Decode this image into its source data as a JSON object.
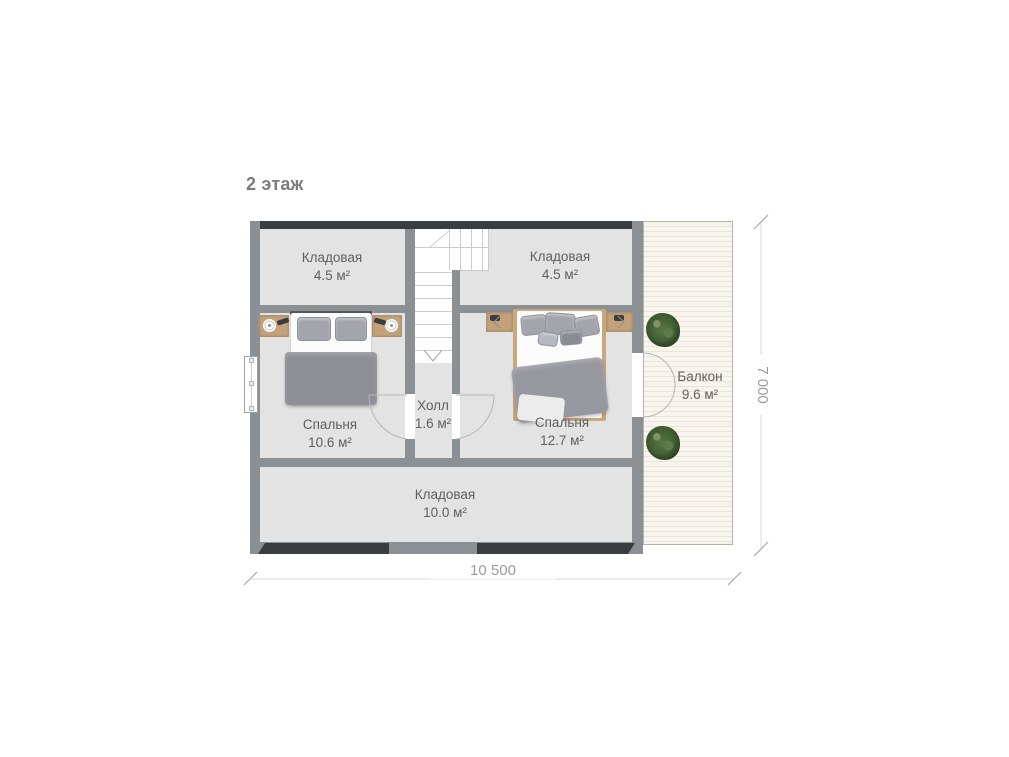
{
  "title": "2 этаж",
  "rooms": {
    "storage_top_left": {
      "name": "Кладовая",
      "area": "4.5 м²"
    },
    "storage_top_right": {
      "name": "Кладовая",
      "area": "4.5 м²"
    },
    "bedroom_left": {
      "name": "Спальня",
      "area": "10.6 м²"
    },
    "bedroom_right": {
      "name": "Спальня",
      "area": "12.7 м²"
    },
    "hall": {
      "name": "Холл",
      "area": "1.6 м²"
    },
    "storage_bottom": {
      "name": "Кладовая",
      "area": "10.0 м²"
    },
    "balcony": {
      "name": "Балкон",
      "area": "9.6 м²"
    }
  },
  "dimensions": {
    "width_label": "10 500",
    "height_label": "7 000"
  },
  "colors": {
    "floor": "#e4e3e3",
    "wall": "#8b9095",
    "wall_dark": "#3a3d40",
    "balcony_floor": "#f8f5ef",
    "balcony_stripe": "#eae5da",
    "wood": "#c3a279",
    "plant_green": "#466033",
    "label_text": "#5f5f5f",
    "dimension_text": "#9b9b9b"
  }
}
